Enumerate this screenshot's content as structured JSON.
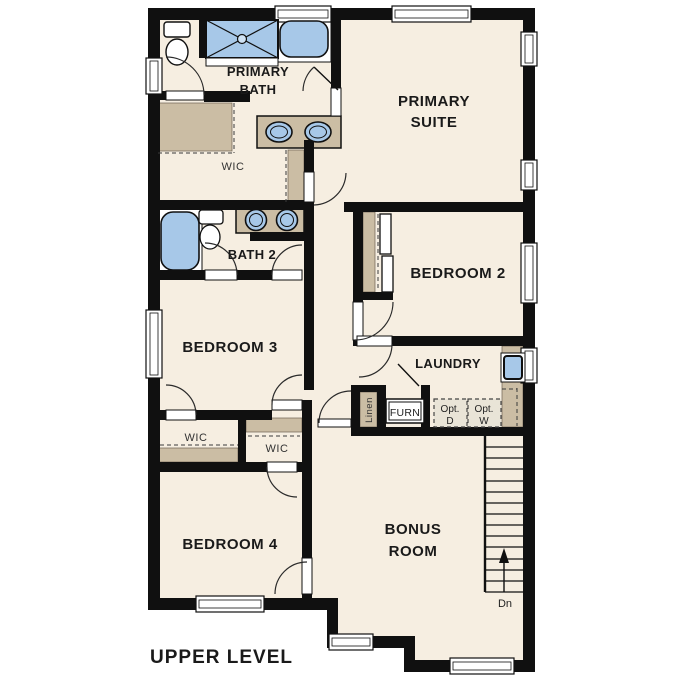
{
  "title": "UPPER LEVEL",
  "colors": {
    "background": "#ffffff",
    "floor": "#f6eee1",
    "walls": "#101010",
    "cabinetry_tan": "#cbbda4",
    "fixture_blue": "#a7c8e8",
    "optional_fill": "#e9e4d7"
  },
  "rooms": {
    "primary_bath": {
      "label_line1": "PRIMARY",
      "label_line2": "BATH"
    },
    "primary_suite": {
      "label_line1": "PRIMARY",
      "label_line2": "SUITE"
    },
    "primary_wic": {
      "label": "WIC"
    },
    "bath2": {
      "label": "BATH 2"
    },
    "bedroom2": {
      "label": "BEDROOM 2"
    },
    "bedroom3": {
      "label": "BEDROOM 3"
    },
    "laundry": {
      "label": "LAUNDRY"
    },
    "linen": {
      "label": "Linen"
    },
    "furnace": {
      "label": "FURN"
    },
    "opt_dryer": {
      "label_line1": "Opt.",
      "label_line2": "D"
    },
    "opt_washer": {
      "label_line1": "Opt.",
      "label_line2": "W"
    },
    "wic_bedroom3": {
      "label": "WIC"
    },
    "wic_bedroom4": {
      "label": "WIC"
    },
    "bedroom4": {
      "label": "BEDROOM 4"
    },
    "bonus_room": {
      "label_line1": "BONUS",
      "label_line2": "ROOM"
    }
  },
  "stairs": {
    "direction_label": "Dn"
  }
}
